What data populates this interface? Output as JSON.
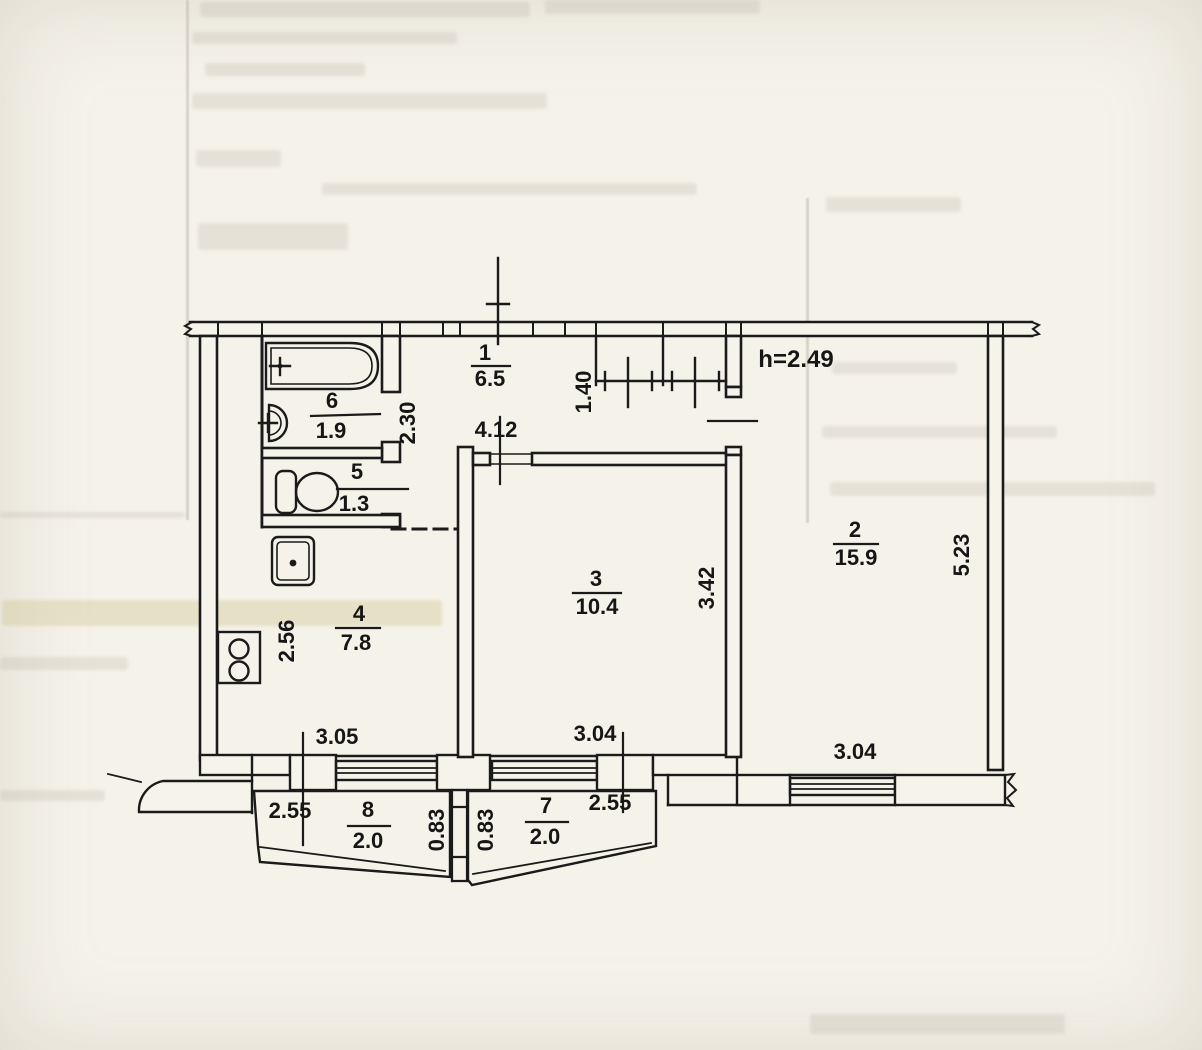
{
  "plan": {
    "ceiling_height_label": "h=2.49",
    "rooms": [
      {
        "number": "1",
        "area": "6.5"
      },
      {
        "number": "2",
        "area": "15.9"
      },
      {
        "number": "3",
        "area": "10.4"
      },
      {
        "number": "4",
        "area": "7.8"
      },
      {
        "number": "5",
        "area": "1.3"
      },
      {
        "number": "6",
        "area": "1.9"
      },
      {
        "number": "7",
        "area": "2.0"
      },
      {
        "number": "8",
        "area": "2.0"
      }
    ],
    "dims": {
      "hall_length": "4.12",
      "closet_depth": "1.40",
      "bath_depth": "2.30",
      "kitchen_depth": "2.56",
      "room3_depth": "3.42",
      "room2_depth": "5.23",
      "kitchen_window": "3.05",
      "room3_window": "3.04",
      "room2_window": "3.04",
      "balcony8_width": "2.55",
      "balcony7_width": "2.55",
      "balcony8_depth": "0.83",
      "balcony7_depth": "0.83"
    },
    "fixtures": [
      "bathtub",
      "washbasin",
      "toilet",
      "kitchen-sink",
      "stove",
      "built-in-wardrobe"
    ],
    "line_color": "#1b1b1b",
    "paper_color": "#f5f2ea"
  }
}
